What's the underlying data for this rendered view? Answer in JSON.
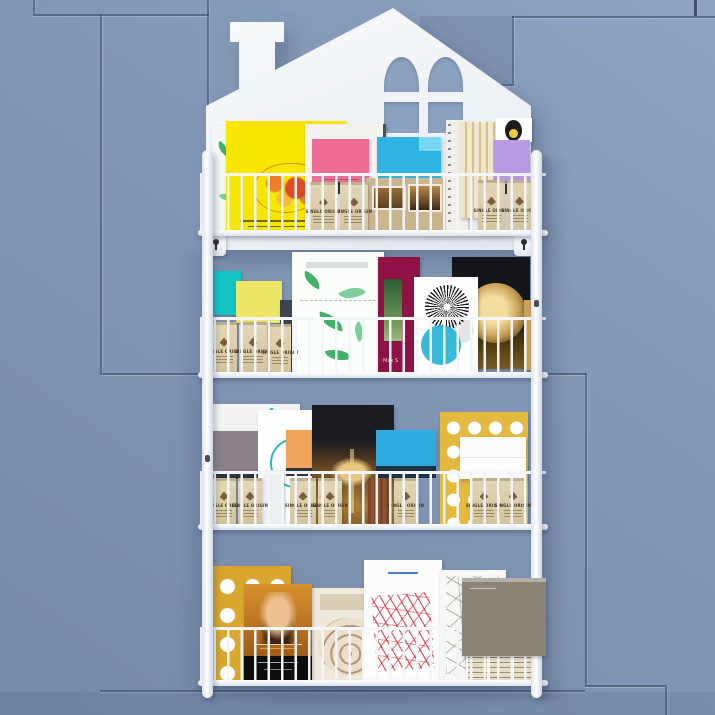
{
  "scene": {
    "type": "product-photograph",
    "subject": "White house-shaped wall-mounted wire book rack with four shelves of books, magazines and boxes",
    "background": "Blue-gray wall with recessed rectangular panel grooves",
    "interactive": false
  },
  "labels": {
    "kraft_bag": "SINGLE ORIGIN",
    "burgundy_book": "Max S"
  },
  "rack": {
    "shelf_count": 4,
    "material": "white coated wire",
    "features": [
      "chimney silhouette",
      "arched 4-pane window cutout",
      "keyhole wall-mount brackets",
      "vertical side rails",
      "wire basket fronts"
    ]
  },
  "colors": {
    "wall_top": "#8ea3c1",
    "wall_mid": "#8095b4",
    "wall_bottom": "#7589a8",
    "groove": "#44587a",
    "recess_panel": "#7287a6",
    "window_pane": "#8ba1c0",
    "rack_white": "#f4f6f8",
    "yellow_mag": "#f7e504",
    "pink_box": "#ef6d95",
    "blue_box": "#2fb3e3",
    "purple_box": "#b79ae1",
    "kraft_bag": "#d9caa9",
    "photo_mag_tan": "#cbb58e",
    "teal_box": "#14c2c4",
    "pale_yellow_box": "#ece566",
    "leaf_green": "#43b06a",
    "burgundy_book": "#8e1243",
    "sunburst_teal": "#28b4d8",
    "black_book": "#14161a",
    "gold_disc": "#caa35b",
    "gray_box": "#8d8289",
    "orange_box": "#f0a55d",
    "blue_box_2": "#2fade1",
    "yellow_dots_book": "#e3b93f",
    "white_box": "#fafbfb",
    "mustard_dots_book": "#d9a62e",
    "portrait_book_orange": "#c07a24",
    "nautilus_cream": "#efe9dc",
    "scribble_red": "#cd1e32",
    "hexagon_white": "#f7f7f5",
    "taupe_book": "#8b8578",
    "dark_slate_book": "#3c4450"
  },
  "shelves": [
    {
      "position": "top",
      "items": [
        {
          "name": "white-leaf-magazine-edge",
          "color": "#f5f7f4"
        },
        {
          "name": "bright-yellow-magazine-with-red-rooster-art",
          "color": "#f7e504"
        },
        {
          "name": "white-magazine",
          "color": "#f5f3ef"
        },
        {
          "name": "pink-box",
          "color": "#ef6d95"
        },
        {
          "name": "blue-box",
          "color": "#2fb3e3"
        },
        {
          "name": "tan-photo-magazine",
          "color": "#cbb58e"
        },
        {
          "name": "ring-bound-white-book",
          "color": "#f2efe8"
        },
        {
          "name": "cream-gold-striped-magazine",
          "color": "#efe6d2"
        },
        {
          "name": "black-and-gold-blob-magazine",
          "color": "#ffffff"
        },
        {
          "name": "lavender-box",
          "color": "#b79ae1"
        },
        {
          "name": "kraft-bags",
          "count": 4,
          "label": "SINGLE ORIGIN"
        }
      ]
    },
    {
      "position": "second",
      "items": [
        {
          "name": "teal-box",
          "color": "#14c2c4"
        },
        {
          "name": "pale-yellow-box",
          "color": "#ece566"
        },
        {
          "name": "dark-slate-book",
          "color": "#3c4450"
        },
        {
          "name": "white-green-leaf-print-magazine",
          "color": "#fbfdfb"
        },
        {
          "name": "burgundy-book-with-forest-photo",
          "color": "#8e1243",
          "label": "Max S"
        },
        {
          "name": "white-sunburst-book-with-teal-circle",
          "color": "#fdfdfd"
        },
        {
          "name": "black-book-with-gold-disc",
          "color": "#14161a"
        },
        {
          "name": "kraft-bags",
          "count": 3,
          "label": "SINGLE ORIGIN"
        }
      ]
    },
    {
      "position": "third",
      "items": [
        {
          "name": "white-magazine",
          "color": "#f2f4f3"
        },
        {
          "name": "gray-box",
          "color": "#8d8289"
        },
        {
          "name": "white-magazine-with-teal-circle-outline",
          "color": "#ffffff"
        },
        {
          "name": "orange-box",
          "color": "#f0a55d"
        },
        {
          "name": "black-book-with-gold-artwork",
          "color": "#1b1d22"
        },
        {
          "name": "blue-box",
          "color": "#2fade1"
        },
        {
          "name": "yellow-book-with-white-dots",
          "color": "#e3b93f"
        },
        {
          "name": "white-box",
          "color": "#fafbfb"
        },
        {
          "name": "kraft-bags",
          "count": 7,
          "label": "SINGLE ORIGIN"
        }
      ]
    },
    {
      "position": "bottom",
      "items": [
        {
          "name": "mustard-book-with-white-dots",
          "color": "#d9a62e"
        },
        {
          "name": "orange-portrait-photo-book",
          "color": "#c07a24"
        },
        {
          "name": "cream-nautilus-shell-book",
          "color": "#efe9dc"
        },
        {
          "name": "white-book-with-red-scribble-art",
          "color": "#fcfcfa"
        },
        {
          "name": "white-book-with-hexagon-line-pattern",
          "color": "#f7f7f5"
        },
        {
          "name": "taupe-gray-book",
          "color": "#8b8578"
        },
        {
          "name": "small-cream-label-books",
          "count": 3,
          "color": "#e6ddc4"
        }
      ]
    }
  ]
}
